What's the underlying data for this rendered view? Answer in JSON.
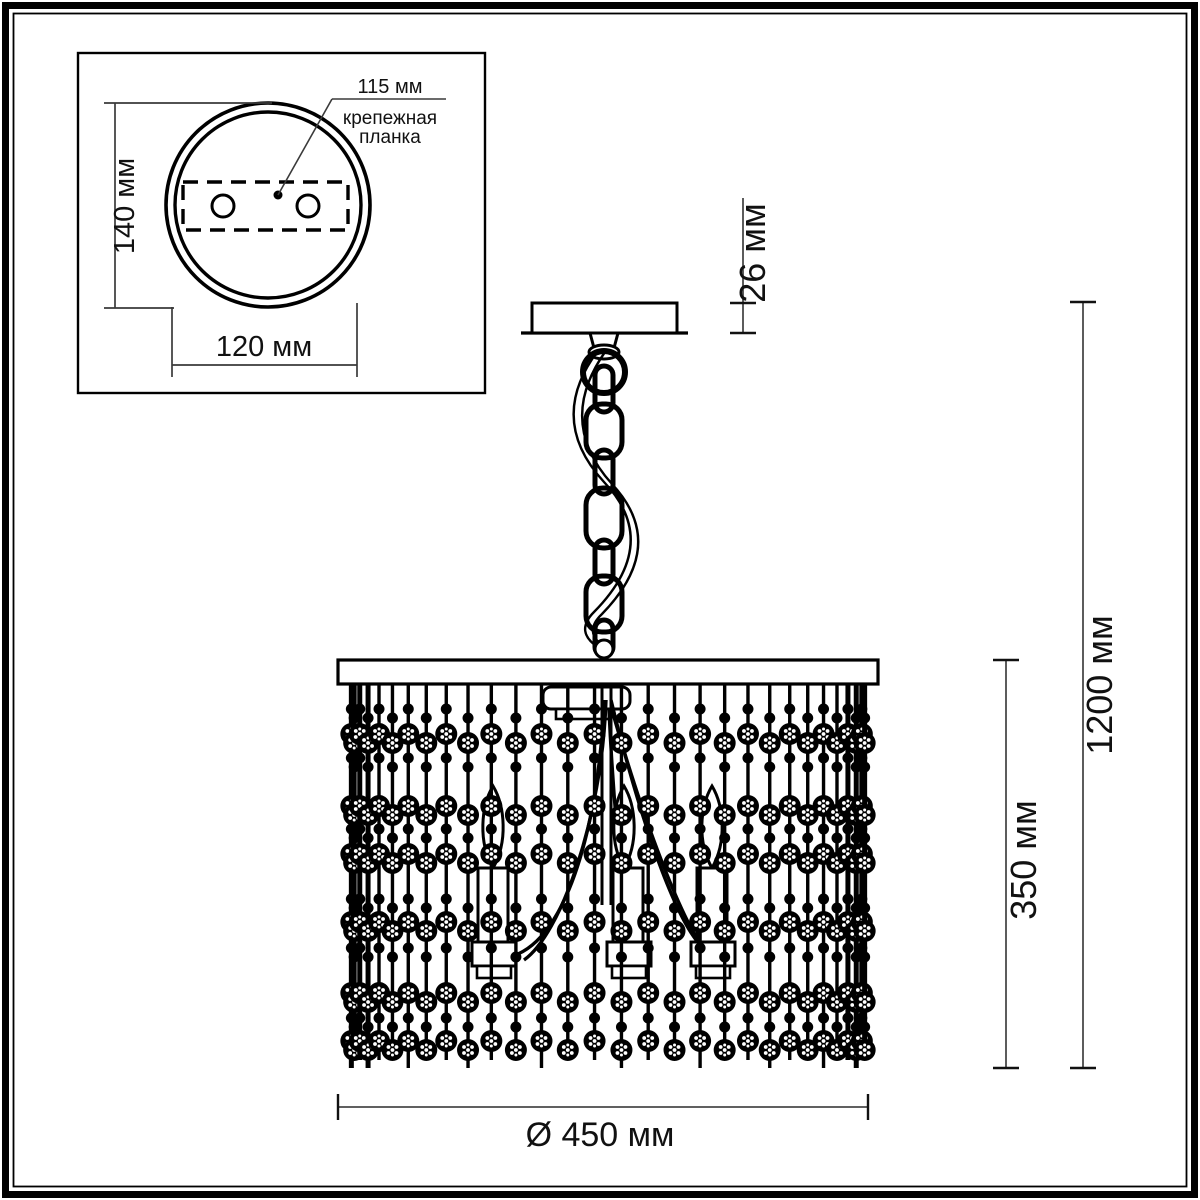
{
  "colors": {
    "line": "#000000",
    "dim_line": "#4a4a4a",
    "background": "#ffffff"
  },
  "inset": {
    "bracket_width_label": "115 мм",
    "bracket_caption_line1": "крепежная",
    "bracket_caption_line2": "планка",
    "plate_height_label": "140 мм",
    "plate_width_label": "120 мм"
  },
  "main": {
    "canopy_height_label": "26 мм",
    "total_height_label": "1200 мм",
    "shade_height_label": "350 мм",
    "diameter_label": "Ø 450 мм"
  }
}
